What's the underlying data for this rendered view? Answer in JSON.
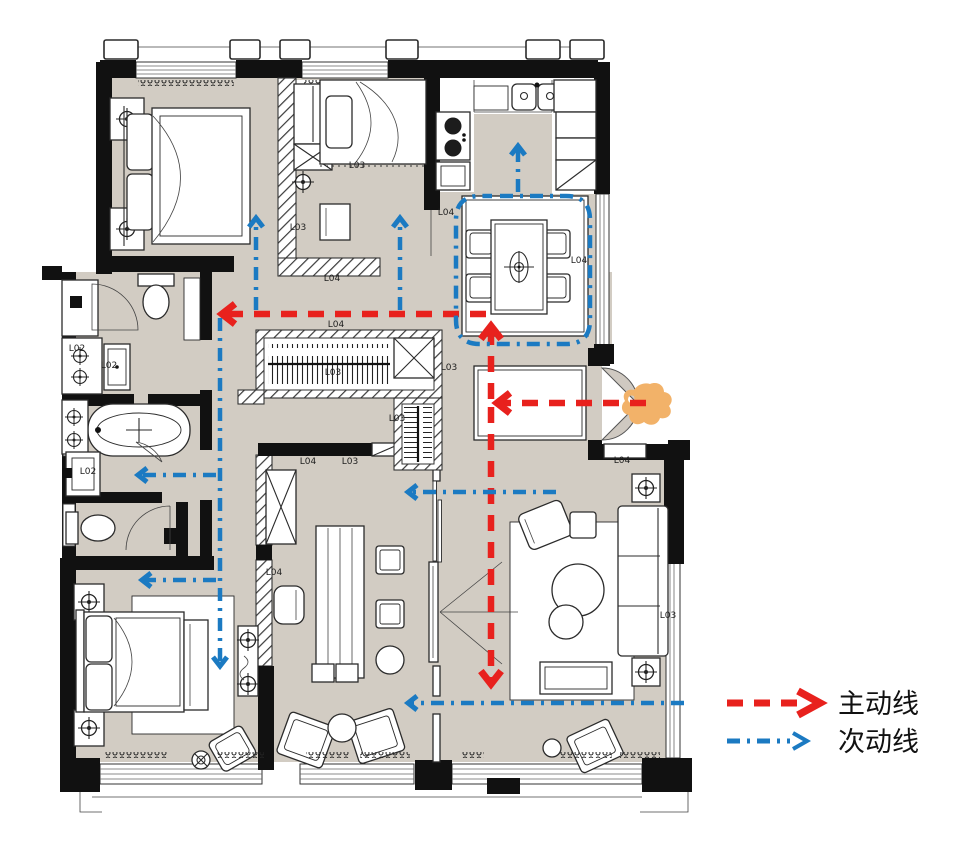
{
  "colors": {
    "floor": "#d2ccc3",
    "wall": "#111111",
    "main_route": "#e8211d",
    "secondary_route": "#1b7ac2",
    "entry_marker": "#f2b269",
    "label": "#1f1f1f"
  },
  "legend": {
    "items": [
      {
        "name": "main-route",
        "label": "主动线",
        "color": "#e8211d",
        "dash": "16 11",
        "width": 6.5
      },
      {
        "name": "secondary-route",
        "label": "次动线",
        "color": "#1b7ac2",
        "dash": "13 7 3 7",
        "width": 4.5
      }
    ]
  },
  "entry_marker": {
    "name": "entrance-marker",
    "color": "#f2b269"
  },
  "room_labels": [
    {
      "text": "L03",
      "x": 357,
      "y": 168
    },
    {
      "text": "L03",
      "x": 298,
      "y": 230
    },
    {
      "text": "L04",
      "x": 332,
      "y": 281
    },
    {
      "text": "L04",
      "x": 446,
      "y": 215
    },
    {
      "text": "L04",
      "x": 579,
      "y": 263
    },
    {
      "text": "L04",
      "x": 336,
      "y": 327
    },
    {
      "text": "L03",
      "x": 333,
      "y": 375
    },
    {
      "text": "L03",
      "x": 449,
      "y": 370
    },
    {
      "text": "L03",
      "x": 397,
      "y": 421
    },
    {
      "text": "L04",
      "x": 308,
      "y": 464
    },
    {
      "text": "L03",
      "x": 350,
      "y": 464
    },
    {
      "text": "L04",
      "x": 274,
      "y": 575
    },
    {
      "text": "L04",
      "x": 622,
      "y": 463
    },
    {
      "text": "L03",
      "x": 668,
      "y": 618
    },
    {
      "text": "L02",
      "x": 77,
      "y": 351
    },
    {
      "text": "L02",
      "x": 109,
      "y": 368
    },
    {
      "text": "L02",
      "x": 88,
      "y": 474
    }
  ],
  "circulation": {
    "main_routes": [
      {
        "name": "entry-to-hall",
        "d": "M 646 403 L 500 403",
        "arrow": {
          "x": 497,
          "y": 403,
          "dir": "left"
        }
      },
      {
        "name": "hall-to-dining",
        "d": "M 491 399 L 491 330",
        "arrow": {
          "x": 491,
          "y": 326,
          "dir": "up"
        }
      },
      {
        "name": "hall-to-living",
        "d": "M 491 407 L 491 679",
        "arrow": {
          "x": 491,
          "y": 684,
          "dir": "down"
        }
      },
      {
        "name": "hall-to-bedrooms",
        "d": "M 486 314 L 226 314",
        "arrow": {
          "x": 222,
          "y": 314,
          "dir": "left"
        }
      }
    ],
    "secondary_routes": [
      {
        "name": "to-master-bedroom",
        "d": "M 256 310 L 256 222",
        "arrow": {
          "x": 256,
          "y": 218,
          "dir": "up"
        }
      },
      {
        "name": "to-second-bedroom",
        "d": "M 400 310 L 400 222",
        "arrow": {
          "x": 400,
          "y": 218,
          "dir": "up"
        }
      },
      {
        "name": "bath-corridor",
        "d": "M 220 318 L 220 662",
        "arrow": {
          "x": 220,
          "y": 666,
          "dir": "down"
        }
      },
      {
        "name": "to-bathroom",
        "d": "M 216 475 L 142 475",
        "arrow": {
          "x": 138,
          "y": 475,
          "dir": "left"
        }
      },
      {
        "name": "to-third-bedroom",
        "d": "M 216 580 L 146 580",
        "arrow": {
          "x": 142,
          "y": 580,
          "dir": "left"
        }
      },
      {
        "name": "dining-loop",
        "d": "M 500 196 L 566 196 Q 590 196 590 220 L 590 320 Q 590 344 566 344 L 480 344 Q 456 344 456 320 L 456 220 Q 456 196 480 196 L 492 196"
      },
      {
        "name": "to-kitchen",
        "d": "M 518 192 L 518 150",
        "arrow": {
          "x": 518,
          "y": 146,
          "dir": "up"
        }
      },
      {
        "name": "living-to-study",
        "d": "M 556 492 L 412 492",
        "arrow": {
          "x": 408,
          "y": 492,
          "dir": "left"
        }
      },
      {
        "name": "living-to-lounge",
        "d": "M 684 703 L 412 703",
        "arrow": {
          "x": 408,
          "y": 703,
          "dir": "left"
        }
      }
    ]
  }
}
